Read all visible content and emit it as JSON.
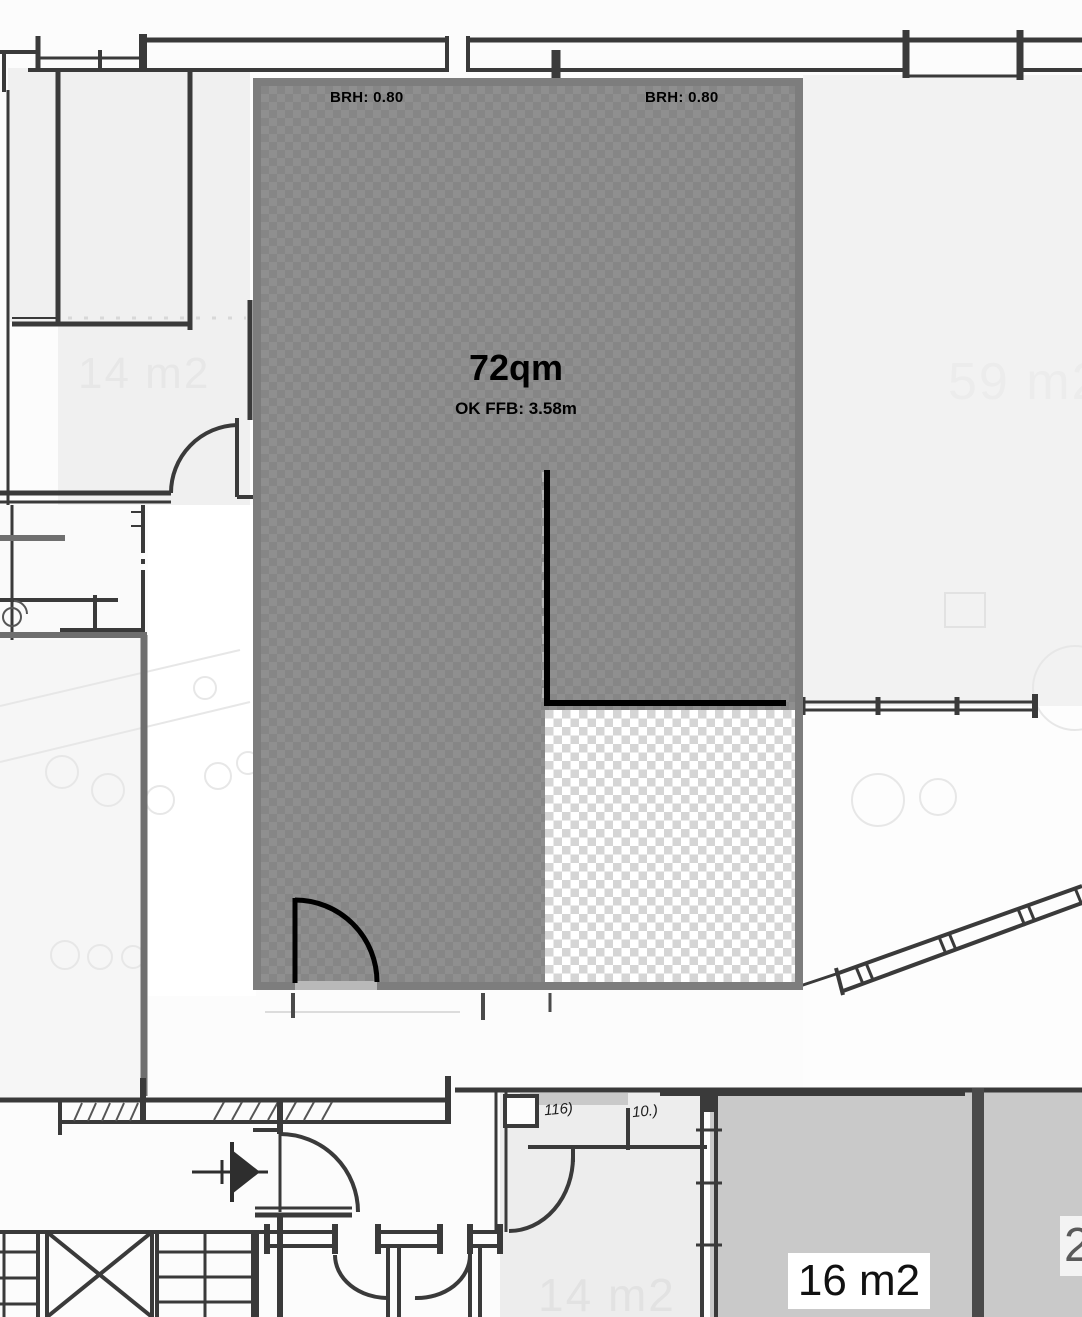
{
  "overlay": {
    "brh_left": "BRH: 0.80",
    "brh_right": "BRH: 0.80",
    "area": "72qm",
    "ffb": "OK FFB: 3.58m",
    "fill_color": "#8a8a8a",
    "border_color": "#7d7d7d",
    "line_color": "#000000"
  },
  "room_labels": {
    "room_14_upper": "14 m2",
    "room_59": "59 m2",
    "room_14_lower": "14 m2",
    "room_16": "16 m2",
    "room_right_partial": "2"
  },
  "handwritten": {
    "note_1": "116)",
    "note_2": "10.)"
  },
  "colors": {
    "room_light": "#f0f0f0",
    "room_gray": "#c9c9c9",
    "wall_sketch": "#3a3a3a",
    "accent_gray": "#6f6f6f",
    "faint_label": "#e7e7e7",
    "checker_light": "#ffffff",
    "checker_shade": "#d5d5d5"
  }
}
